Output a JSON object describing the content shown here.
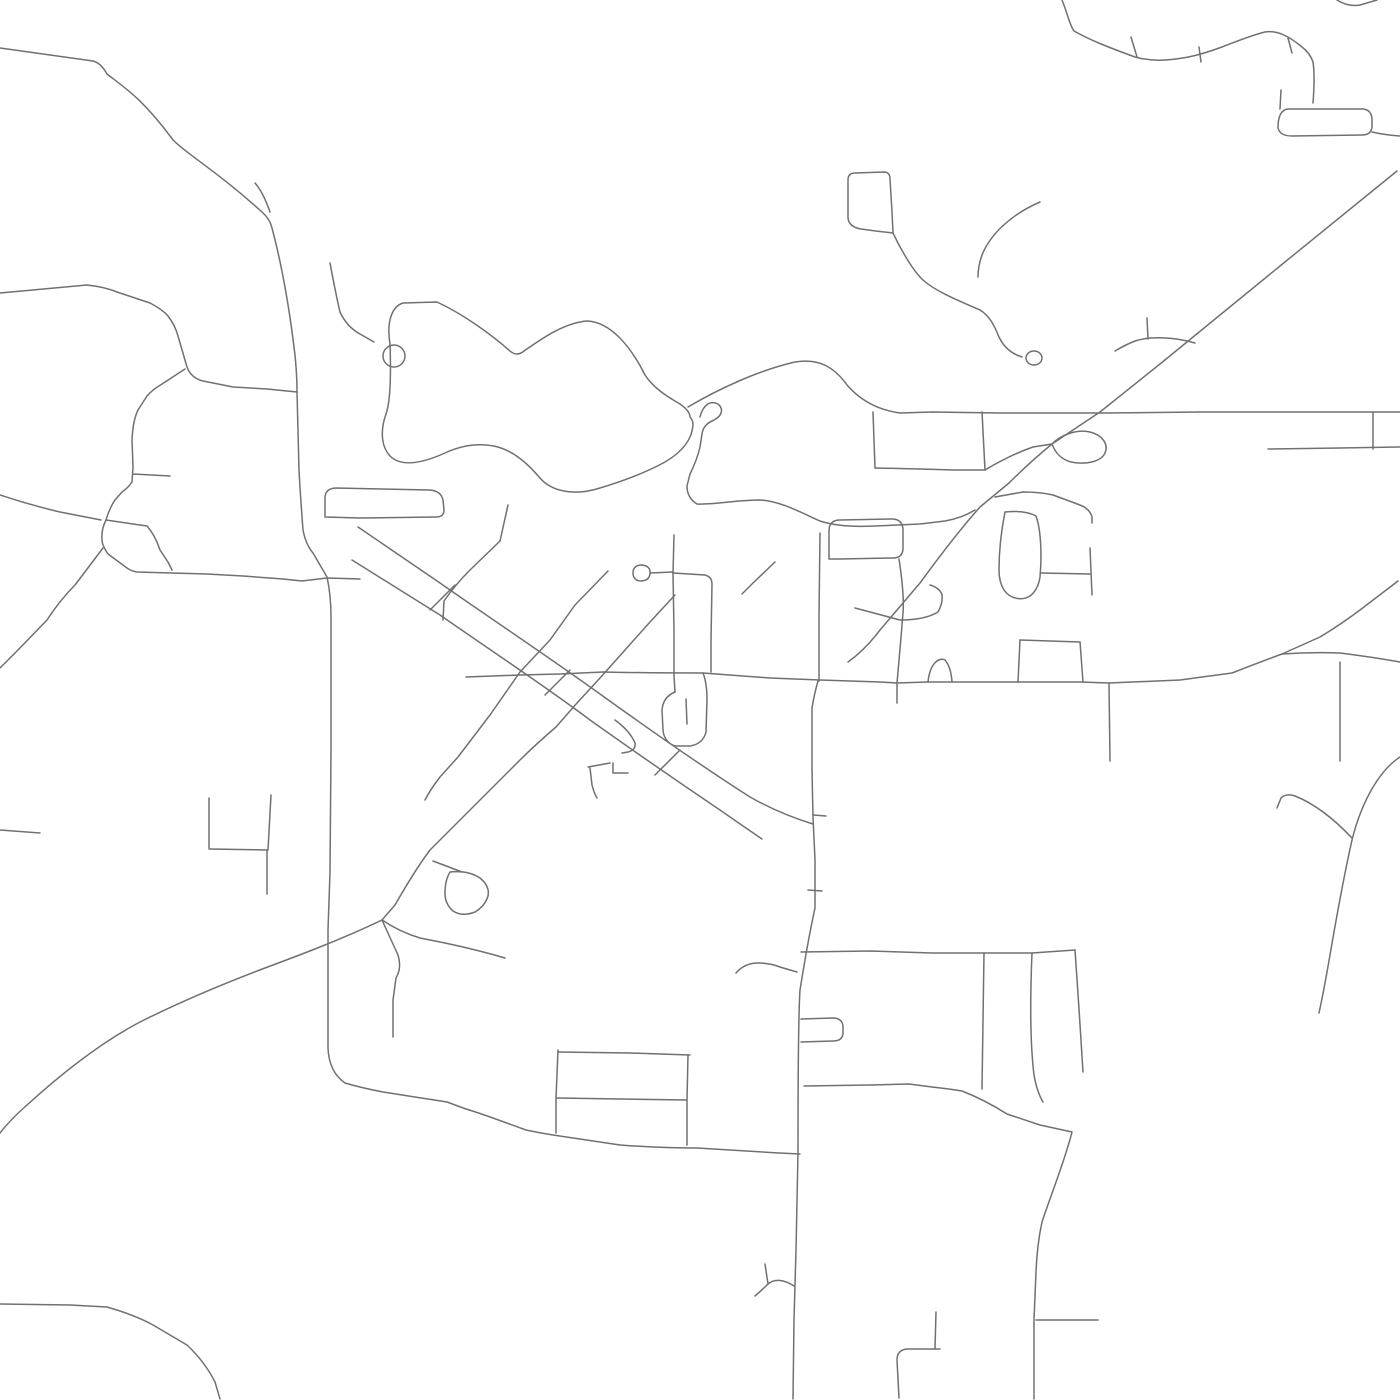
{
  "map": {
    "canvas": {
      "width": 1400,
      "height": 1400,
      "background": "#ffffff"
    },
    "style": {
      "stroke": "#707070",
      "stroke_width": 1.5,
      "linecap": "round",
      "linejoin": "round"
    },
    "roads": [
      {
        "id": "nw-diagonal-main-road",
        "d": "M 0 48 L 93 61 Q 101 63 107 74 C 125 88 143 99 173 140 C 188 155 218 172 262 212 Q 270 219 272 228 C 280 258 288 296 295 355 Q 297 375 297 392 L 299 470 Q 300 490 303 530 Q 306 545 313 553 L 327 577 Q 331 595 331 617 L 331 750 330 872 328 930 328 1005 328 1048 Q 329 1072 345 1083 Q 362 1088 383 1092 L 447 1102 466 1109 C 480 1113 493 1118 526 1130 Q 540 1133 553 1135 L 620 1145 Q 660 1148 697 1148 L 779 1153 800 1154"
      },
      {
        "id": "nw-fork-arm",
        "d": "M 255 183 Q 263 192 270 212"
      },
      {
        "id": "west-road",
        "d": "M 0 293 L 87 285 Q 105 287 117 292 L 150 303 Q 163 310 168 316 Q 175 325 178 336 L 187 367 Q 191 378 203 381 L 233 387 267 389 297 392"
      },
      {
        "id": "west-branch-street",
        "d": "M 185 369 L 162 384 Q 152 390 147 396 L 138 410 Q 133 420 132 440 L 133 467 132 482 Q 128 488 122 492 L 115 500 Q 110 507 106 520 Q 101 530 102 540 Q 102 545 108 554 L 127 568 Q 131 571 137 572 L 207 574 243 576 283 579 302 581 327 578 360 579"
      },
      {
        "id": "pentagon-inner-street",
        "d": "M 106 520 L 147 526 Q 155 535 160 550 L 168 562 172 570"
      },
      {
        "id": "west-stub-street",
        "d": "M 133 474 L 170 476"
      },
      {
        "id": "left-edge-upper-road",
        "d": "M 0 495 Q 30 505 60 512 L 101 520"
      },
      {
        "id": "left-edge-lower-road",
        "d": "M 103 548 L 75 585 Q 60 600 47 620 L 18 650 0 668"
      },
      {
        "id": "left-edge-stub",
        "d": "M 0 830 L 40 833"
      },
      {
        "id": "pond-circle-loop",
        "d": "M 383 356 a 11 11 0 1 0 22 0 a 11 11 0 1 0 -22 0"
      },
      {
        "id": "pond-connector-road",
        "d": "M 330 263 Q 336 295 340 312 Q 347 327 360 334 L 374 342"
      },
      {
        "id": "lake-loop-road",
        "d": "M 390 344 C 386 320 393 306 403 303 L 437 302 C 465 315 493 336 510 351 Q 517 357 524 351 C 540 340 563 323 587 321 C 610 322 630 345 645 375 C 655 390 670 398 680 404 Q 690 411 690 417 Q 693 420 693 425 C 692 440 682 452 665 462 C 645 473 620 482 600 488 C 575 496 552 492 540 478 C 528 464 515 452 498 447 C 478 442 460 446 445 453 C 425 462 402 468 390 456 C 380 445 381 428 386 414 C 391 400 391 372 390 344"
      },
      {
        "id": "lake-east-road",
        "d": "M 688 407 C 720 388 760 370 795 362 C 820 358 835 368 847 385 C 860 400 878 410 900 413 L 932 412 1000 413 1105 413 1200 412 1268 412 1400 412"
      },
      {
        "id": "balloon-loop-street",
        "d": "M 700 417 C 703 405 710 400 718 404 C 724 409 722 416 714 420 C 707 423 703 427 702 434 L 700 447 Q 697 460 690 474 L 687 486 Q 687 498 697 504 C 715 505 735 500 760 500 C 780 501 800 512 820 521 C 835 526 855 527 875 526 L 920 524 945 521 Q 962 518 975 510"
      },
      {
        "id": "north-vertical-street-a",
        "d": "M 873 412 L 875 468"
      },
      {
        "id": "north-vertical-street-b",
        "d": "M 982 412 L 985 470"
      },
      {
        "id": "north-connector-street",
        "d": "M 875 468 L 920 469 955 470 985 470"
      },
      {
        "id": "junction-curve-road",
        "d": "M 985 470 Q 1010 455 1033 447 L 1052 444"
      },
      {
        "id": "junction-balloon-loop",
        "d": "M 1052 444 C 1062 434 1078 429 1090 432 C 1102 435 1109 444 1105 453 C 1101 462 1085 465 1071 462 C 1060 459 1055 452 1052 444"
      },
      {
        "id": "ne-straight-highway",
        "d": "M 1397 171 L 1280 266 1160 364 1100 412 1052 444 Q 1030 462 1009 483 L 980 507 Q 955 535 920 583 L 880 630 Q 865 650 848 662"
      },
      {
        "id": "s-curve-road",
        "d": "M 893 233 C 900 248 913 271 923 280 C 935 291 957 300 980 310 C 990 316 995 327 999 337 Q 1006 352 1022 357"
      },
      {
        "id": "s-curve-end-circle",
        "d": "M 1026 358 a 8 7 0 1 0 16 0 a 8 7 0 1 0 -16 0"
      },
      {
        "id": "top-rect-loop",
        "d": "M 848 218 L 848 180 Q 848 173 855 173 L 884 172 Q 890 172 890 179 L 892 212 893 233 Q 875 231 861 229 Q 849 227 848 218"
      },
      {
        "id": "dead-end-curve-road",
        "d": "M 1040 202 C 1010 215 990 235 982 255 Q 978 266 978 277"
      },
      {
        "id": "top-wavy-road",
        "d": "M 1062 0 C 1068 15 1070 26 1074 31 C 1090 40 1105 46 1135 57 Q 1150 61 1165 60 C 1180 59 1195 57 1222 47 C 1235 42 1252 35 1265 32 C 1278 30 1290 37 1302 47 Q 1310 53 1313 62 C 1315 75 1314 90 1313 103"
      },
      {
        "id": "wavy-road-tick-1",
        "d": "M 1131 37 L 1137 57"
      },
      {
        "id": "wavy-road-tick-2",
        "d": "M 1199 47 L 1201 62"
      },
      {
        "id": "wavy-road-tick-3",
        "d": "M 1288 38 L 1292 53"
      },
      {
        "id": "top-right-arc",
        "d": "M 1337 0 Q 1348 7 1360 5 L 1377 0"
      },
      {
        "id": "ne-rect-stem",
        "d": "M 1281 90 L 1280 109"
      },
      {
        "id": "ne-rect-loop",
        "d": "M 1278 128 Q 1278 110 1288 109 L 1363 109 Q 1372 110 1372 120 L 1372 127 Q 1371 135 1362 135 L 1292 136 Q 1280 136 1278 128 Z"
      },
      {
        "id": "ne-rect-extension",
        "d": "M 1372 132 Q 1385 135 1400 136"
      },
      {
        "id": "right-road-lower",
        "d": "M 1268 449 L 1340 448 1400 447"
      },
      {
        "id": "right-connector-street",
        "d": "M 1373 412 L 1373 449"
      },
      {
        "id": "arc-below-highway",
        "d": "M 1195 343 C 1175 337 1150 336 1135 341 Q 1125 345 1115 351"
      },
      {
        "id": "arc-stub-street",
        "d": "M 1147 318 L 1148 339"
      },
      {
        "id": "east-side-street",
        "d": "M 995 497 L 1023 492 Q 1040 492 1053 495 L 1080 505 Q 1090 509 1092 517 L 1092 523"
      },
      {
        "id": "east-culdesac-loop",
        "d": "M 1005 512 Q 1025 510 1036 516 C 1041 530 1042 555 1040 577 Q 1038 590 1030 596 C 1022 601 1010 599 1004 590 Q 999 582 999 570 C 999 550 1001 532 1005 512"
      },
      {
        "id": "east-loop-stub",
        "d": "M 1041 573 L 1090 574"
      },
      {
        "id": "east-loop-vertical",
        "d": "M 1090 548 L 1092 595"
      },
      {
        "id": "culdesac-hook-street",
        "d": "M 855 608 L 900 620 Q 925 620 938 612 Q 943 603 942 595 Q 940 588 930 585"
      },
      {
        "id": "main-east-west-road",
        "d": "M 466 677 L 520 675 560 674 603 672 Q 650 673 703 673 L 770 678 820 680 880 682 897 683 928 682 952 682 1020 682 1080 682 1109 683 1180 680 1232 673 Q 1260 662 1282 654 Q 1310 652 1340 653 Q 1372 657 1400 662"
      },
      {
        "id": "roadside-arch-loop",
        "d": "M 928 682 C 930 662 940 657 945 660 Q 951 667 952 682"
      },
      {
        "id": "mid-north-south-street",
        "d": "M 899 559 C 903 585 904 600 903 613 Q 900 650 897 683 L 897 703"
      },
      {
        "id": "block-top-street",
        "d": "M 1020 640 L 1080 642"
      },
      {
        "id": "block-left-street",
        "d": "M 1020 640 L 1018 682"
      },
      {
        "id": "block-right-street",
        "d": "M 1080 642 L 1083 682"
      },
      {
        "id": "south-stub-street",
        "d": "M 1109 683 L 1110 761"
      },
      {
        "id": "right-vertical-street",
        "d": "M 1340 662 L 1340 761"
      },
      {
        "id": "se-merge-diagonal",
        "d": "M 1398 581 L 1360 610 Q 1340 625 1320 637 L 1282 654"
      },
      {
        "id": "mid-rounded-rect-loop",
        "d": "M 829 559 L 829 531 Q 829 520 840 520 L 892 519 Q 902 519 903 529 L 903 548 Q 903 558 893 558 L 840 559 829 559 Z"
      },
      {
        "id": "vertical-street-819",
        "d": "M 820 533 L 819 616 819 681"
      },
      {
        "id": "main-north-south-road",
        "d": "M 818 681 Q 814 695 812 708 L 812 770 813 817 815 860 815 908 Q 808 940 800 990 Q 798 1020 798 1152 L 796 1250 794 1320 793 1399"
      },
      {
        "id": "vertical-stub-a",
        "d": "M 813 815 L 826 816"
      },
      {
        "id": "vertical-stub-b",
        "d": "M 808 890 L 822 891"
      },
      {
        "id": "vertical-rect-loop",
        "d": "M 801 1019 L 833 1018 Q 842 1018 843 1026 L 843 1034 Q 842 1041 833 1041 L 801 1042"
      },
      {
        "id": "squiggle-connector",
        "d": "M 736 973 C 742 966 750 963 758 963 Q 770 963 780 967 Q 790 970 797 972"
      },
      {
        "id": "y-fork-branch",
        "d": "M 794 1286 C 785 1280 775 1278 768 1284 Q 762 1290 755 1296"
      },
      {
        "id": "y-fork-tail",
        "d": "M 768 1284 L 765 1264"
      },
      {
        "id": "east-horizontal-952",
        "d": "M 801 952 L 870 951 932 953 985 953 1032 953 1075 950"
      },
      {
        "id": "descender-street-1",
        "d": "M 984 953 L 982 1089"
      },
      {
        "id": "descender-street-2",
        "d": "M 1032 953 C 1030 1000 1030 1042 1034 1075 Q 1037 1092 1043 1102"
      },
      {
        "id": "descender-street-3",
        "d": "M 1075 950 L 1079 1009 1083 1072"
      },
      {
        "id": "se-long-road",
        "d": "M 804 1086 L 870 1085 909 1084 932 1087 Q 950 1089 962 1091 Q 985 1100 1007 1114 L 1040 1125 1072 1132 C 1065 1160 1052 1192 1042 1222 Q 1037 1245 1036 1272 L 1034 1320 1034 1399"
      },
      {
        "id": "se-stub-street",
        "d": "M 1036 1320 L 1098 1320"
      },
      {
        "id": "corridor-street-north",
        "d": "M 358 527 L 440 583 C 490 618 550 658 600 694 C 650 730 700 765 750 797 Q 780 814 813 824"
      },
      {
        "id": "corridor-street-south",
        "d": "M 352 560 L 440 615 C 490 650 545 686 590 720 C 635 752 680 783 720 810 Q 740 824 762 839"
      },
      {
        "id": "cross-street-1",
        "d": "M 500 541 L 470 570 Q 455 585 444 601 L 443 620"
      },
      {
        "id": "cross-street-1-ext",
        "d": "M 508 505 L 500 541"
      },
      {
        "id": "cross-street-2",
        "d": "M 608 571 L 575 605 550 640 520 672 490 715 458 757 440 777 Q 430 790 425 800"
      },
      {
        "id": "cross-street-3",
        "d": "M 675 595 L 650 622 625 650 600 678 577 703 556 727 Q 535 745 520 760 L 460 820 430 850 Q 415 870 395 905 L 382 920"
      },
      {
        "id": "corridor-rung-1",
        "d": "M 430 610 L 455 585"
      },
      {
        "id": "corridor-rung-2",
        "d": "M 545 695 L 570 670"
      },
      {
        "id": "corridor-rung-3",
        "d": "M 655 775 L 680 750"
      },
      {
        "id": "sw-sweep-road",
        "d": "M 382 920 C 340 940 300 955 265 968 C 220 985 180 1002 140 1022 C 100 1043 60 1075 27 1105 Q 10 1120 0 1133"
      },
      {
        "id": "sw-branch-road",
        "d": "M 382 920 Q 400 932 420 938 L 445 943 Q 478 950 505 958"
      },
      {
        "id": "south-wiggle-street",
        "d": "M 382 920 L 398 955 Q 402 968 396 978 L 393 1000 393 1037"
      },
      {
        "id": "se-blob-loop",
        "d": "M 450 872 Q 468 870 480 878 Q 490 886 488 896 Q 485 906 475 912 Q 462 917 453 911 Q 445 904 445 893 Q 445 880 450 872"
      },
      {
        "id": "se-blob-rung",
        "d": "M 433 861 L 462 872"
      },
      {
        "id": "sw-bottom-road",
        "d": "M 0 1304 L 70 1305 107 1307 Q 135 1315 153 1325 L 187 1345 Q 205 1362 215 1382 L 220 1399"
      },
      {
        "id": "south-block-vertical-1",
        "d": "M 558 1050 L 556 1098 556 1133"
      },
      {
        "id": "south-block-vertical-2",
        "d": "M 688 1055 L 687 1100 687 1145"
      },
      {
        "id": "south-block-top",
        "d": "M 558 1052 L 630 1053 690 1055"
      },
      {
        "id": "south-block-middle",
        "d": "M 557 1098 L 687 1100"
      },
      {
        "id": "bottom-corner-road",
        "d": "M 899 1398 L 897 1360 Q 897 1350 907 1349 L 940 1349"
      },
      {
        "id": "bottom-corner-tick",
        "d": "M 936 1312 L 935 1349"
      },
      {
        "id": "bottom-right-curve-road",
        "d": "M 1400 757 C 1380 770 1362 800 1352 840 C 1343 880 1336 920 1330 955 Q 1324 990 1319 1013"
      },
      {
        "id": "bottom-right-hook",
        "d": "M 1352 838 C 1335 820 1315 804 1295 796 Q 1286 793 1281 798 L 1277 808"
      },
      {
        "id": "west-block-left-vertical",
        "d": "M 209 798 L 209 848"
      },
      {
        "id": "west-block-horizontal",
        "d": "M 209 849 L 267 850"
      },
      {
        "id": "west-block-right-vertical",
        "d": "M 271 795 L 268 850"
      },
      {
        "id": "west-block-descender",
        "d": "M 267 850 L 267 894"
      },
      {
        "id": "ring-oval-loop",
        "d": "M 633 573 Q 633 565 642 565 Q 651 566 650 574 Q 649 581 640 581 Q 633 580 633 573"
      },
      {
        "id": "ring-access-street",
        "d": "M 650 573 L 673 572"
      },
      {
        "id": "ns-street-673",
        "d": "M 674 535 L 673 573 674 630 674 676 675 692"
      },
      {
        "id": "p-loop-street",
        "d": "M 675 692 Q 663 697 662 710 L 663 730 Q 664 742 675 746 L 690 746 Q 703 744 706 732 L 707 700 Q 707 683 703 673"
      },
      {
        "id": "p-loop-stub",
        "d": "M 686 699 L 687 724"
      },
      {
        "id": "corner-street",
        "d": "M 673 573 L 705 575 Q 712 577 712 584 L 711 640 711 672"
      },
      {
        "id": "ne-fragment-street",
        "d": "M 775 562 L 753 583 Q 747 589 742 594"
      },
      {
        "id": "f-street-top",
        "d": "M 588 767 L 610 763"
      },
      {
        "id": "f-street-arm",
        "d": "M 613 763 L 613 773 628 773"
      },
      {
        "id": "f-street-stem",
        "d": "M 590 768 L 592 785 Q 594 793 597 798"
      },
      {
        "id": "small-curl-street",
        "d": "M 615 720 Q 630 731 635 743 Q 636 750 628 752 L 622 753"
      },
      {
        "id": "west-rounded-rect-loop",
        "d": "M 325 517 L 325 498 Q 325 489 335 488 L 430 490 Q 441 491 443 500 L 444 510 Q 444 517 436 517 L 360 518 325 517 Z"
      }
    ]
  }
}
